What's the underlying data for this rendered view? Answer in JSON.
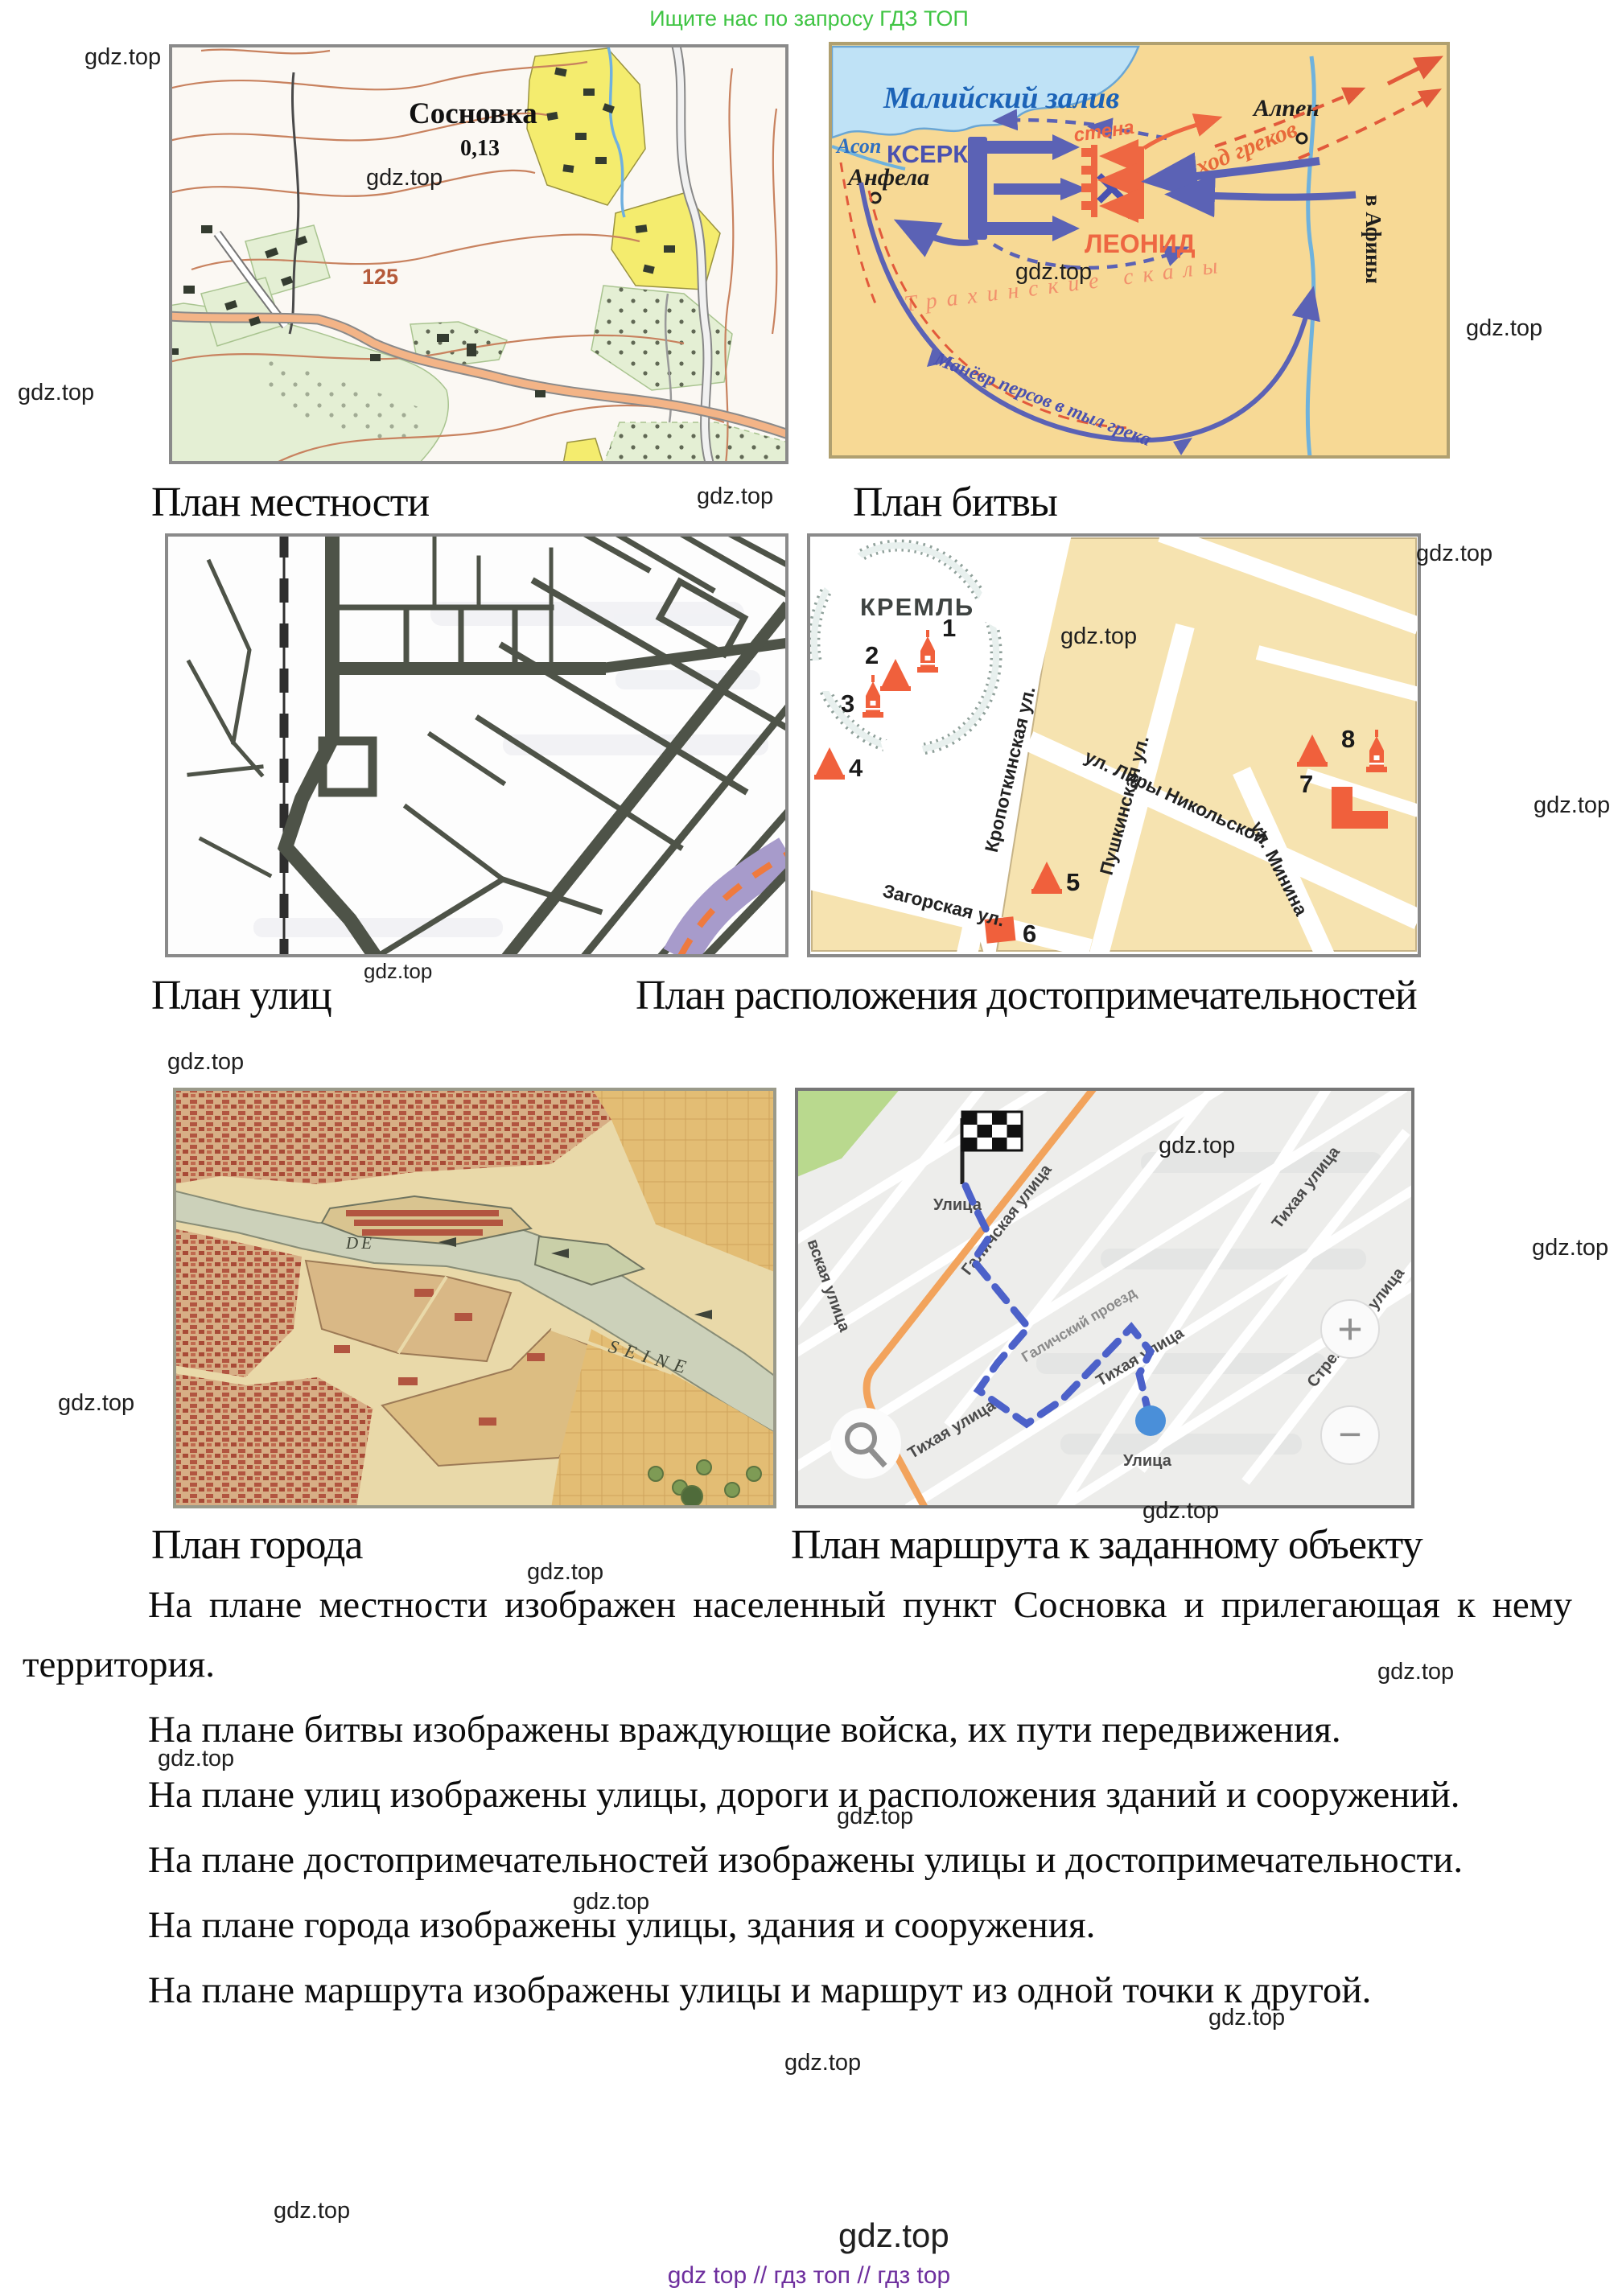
{
  "promo": "Ищите нас по запросу ГДЗ ТОП",
  "watermark": "gdz.top",
  "footer_links": "gdz top  //  гдз топ  //  гдз top",
  "captions": {
    "terrain": "План местности",
    "battle": "План битвы",
    "streets": "План улиц",
    "landmarks": "План расположения достопримечательностей",
    "city": "План города",
    "route": "План маршрута к заданному объекту"
  },
  "terrain": {
    "village": "Сосновка",
    "density": "0,13",
    "elevation": "125"
  },
  "battle": {
    "gulf": "Малийский залив",
    "asop": "Асоп",
    "xerxes": "КСЕРКС",
    "anfela": "Анфела",
    "alpen": "Алпен",
    "wall": "стена",
    "retreat": "отход греков",
    "athens": "в Афины",
    "leonid": "ЛЕОНИД",
    "rocks": "Трахинские скалы",
    "maneuver": "Манёвр персов в тыл грека"
  },
  "landmarks": {
    "title": "КРЕМЛЬ",
    "nums": [
      "1",
      "2",
      "3",
      "4",
      "5",
      "6",
      "7",
      "8"
    ],
    "st_kropotkinskaya": "Кропоткинская ул.",
    "st_liry": "ул. Лиры Никольской",
    "st_pushkinskaya": "Пушкинская ул.",
    "st_zagorskaya": "Загорская ул.",
    "st_minina": "ул. Минина"
  },
  "city": {
    "de": "DE",
    "seine": "SEINE"
  },
  "route": {
    "ulitsa": "Улица",
    "galichskaya": "Галичская улица",
    "proezd": "Галичский проезд",
    "tikhaya": "Тихая улица",
    "strelkovaya": "Стрелковая улица",
    "partial": "вская улица",
    "plus": "+",
    "minus": "−"
  },
  "paragraphs": [
    "На плане местности изображен населенный пункт Сосновка и прилегающая к нему территория.",
    "На плане битвы изображены враждующие войска, их пути передвижения.",
    "На плане улиц изображены улицы, дороги и расположения зданий и сооружений.",
    "На плане достопримечательностей изображены улицы и достопримечательности.",
    "На плане города изображены улицы, здания и сооружения.",
    "На плане маршрута изображены улицы и маршрут из одной точки к другой."
  ]
}
